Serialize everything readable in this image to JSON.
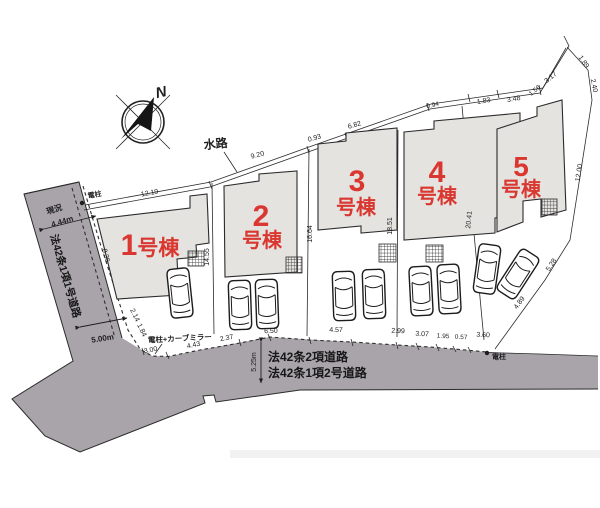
{
  "compass": {
    "north": "N"
  },
  "waterway": {
    "label": "水路",
    "segments": [
      "12.19",
      "9.20",
      "0.93",
      "6.82",
      "0.94",
      "1.83",
      "3.48",
      "1.56",
      "3.17"
    ]
  },
  "northeast_boundary": [
    "1.89",
    "2.40",
    "12.00",
    "5.28",
    "4.89"
  ],
  "lot_boundaries": {
    "b12": "14.55",
    "b23": "16.64",
    "b34": "18.51",
    "b45": "20.41"
  },
  "lot1": {
    "side": "8.36",
    "corner_a": "2.14",
    "corner_b": "1.84"
  },
  "frontage": [
    "3.00",
    "4.43",
    "2.37",
    "6.50",
    "4.57",
    "2.99",
    "3.07",
    "1.95",
    "0.57",
    "3.60"
  ],
  "left_road": {
    "status": "現況",
    "width": "4.44m",
    "name": "法42条1項1号道路",
    "south_width": "5.00m"
  },
  "bottom_road": {
    "width": "5.25m",
    "name1": "法42条2項道路",
    "name2": "法42条1項2号道路"
  },
  "poles": {
    "top": "電柱",
    "mirror": "電柱+カーブミラー",
    "east": "電柱"
  },
  "buildings": [
    {
      "num": "1",
      "suffix": "号棟"
    },
    {
      "num": "2",
      "suffix": "号棟"
    },
    {
      "num": "3",
      "suffix": "号棟"
    },
    {
      "num": "4",
      "suffix": "号棟"
    },
    {
      "num": "5",
      "suffix": "号棟"
    }
  ],
  "colors": {
    "accent_red": "#d9372f",
    "road_gray": "#a8a4aa",
    "building_gray": "#e4e3df"
  }
}
